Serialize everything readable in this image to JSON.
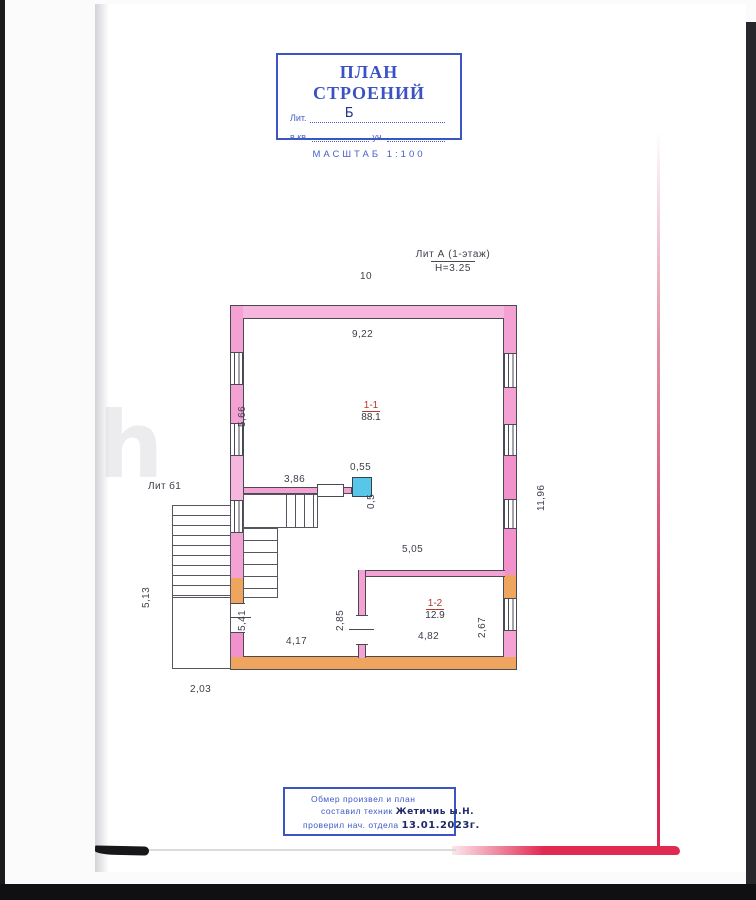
{
  "page_number": "10",
  "watermark": "h",
  "title_block": {
    "title": "ПЛАН СТРОЕНИЙ",
    "lit_label": "Лит.",
    "lit_value": "Б",
    "kv_label": "в кв.",
    "uch_label": "уч.",
    "scale": "МАСШТАБ 1:100"
  },
  "building_label": {
    "line1": "Лит А (1-этаж)",
    "line2": "Н=3.25"
  },
  "annex_label": "Лит б1",
  "rooms": [
    {
      "number": "1-1",
      "area": "88.1"
    },
    {
      "number": "1-2",
      "area": "12.9"
    }
  ],
  "dimensions": {
    "top_inner": "9,22",
    "left_upper": "5,66",
    "inner_wall": "3,86",
    "stove_width": "0,55",
    "stove_depth": "0,5",
    "right_total": "11,96",
    "annex_height": "5,13",
    "left_lower": "5,41",
    "room2_left": "2,85",
    "room2_top": "5,05",
    "room2_right": "2,67",
    "bottom_left": "4,17",
    "room2_bottom": "4,82",
    "annex_width": "2,03"
  },
  "footer_block": {
    "line1": "Обмер произвел и план",
    "line2_label": "составил техник",
    "line2_value": "Жетичиь ы.Н.",
    "line3_label": "проверил нач. отдела",
    "line3_value": "13.01.2023г."
  }
}
